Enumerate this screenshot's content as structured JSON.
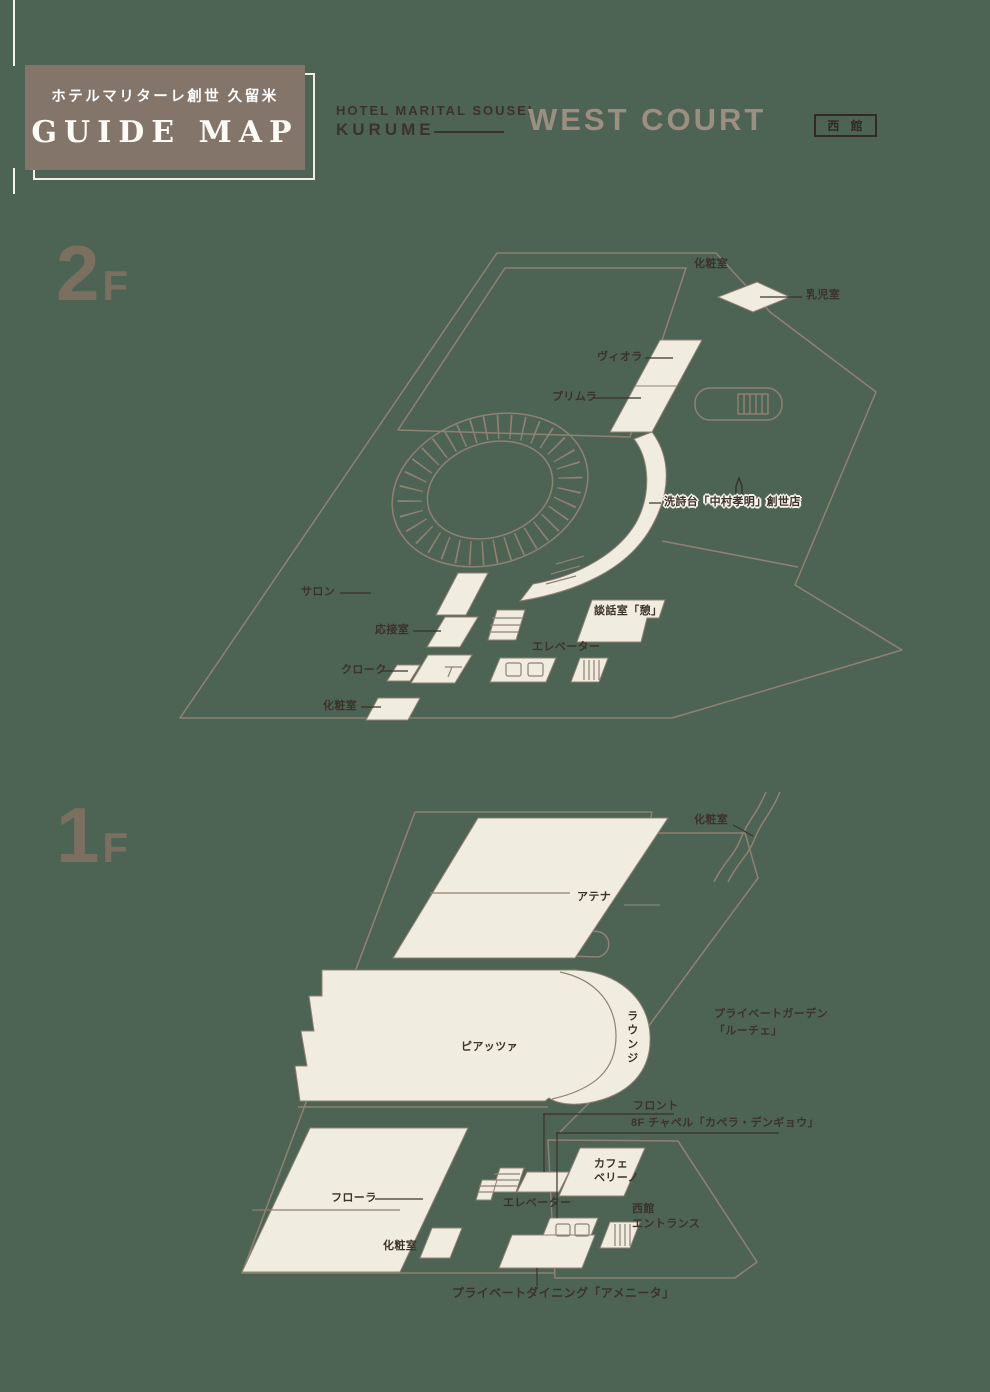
{
  "colors": {
    "background": "#4D6455",
    "room_cream": "#F1ECE0",
    "wall_line": "#8F8173",
    "ink": "#3B322A",
    "logo_box": "#84756A",
    "floor_numeral": "#7B7060",
    "court_title": "#9C8E81"
  },
  "header": {
    "logo_jp": "ホテルマリターレ創世 久留米",
    "logo_en": "GUIDE MAP",
    "hotel_en_line1": "HOTEL MARITAL SOUSEI",
    "hotel_en_line2": "KURUME",
    "building_en": "WEST COURT",
    "building_badge": "西 館"
  },
  "icons": {
    "restaurant_marker": "spire-icon"
  },
  "floor2": {
    "number": "2",
    "suffix": "F",
    "labels": {
      "restroom_top": "化粧室",
      "nursing_room": "乳児室",
      "viola": "ヴィオラ",
      "primula": "プリムラ",
      "restaurant": "洗詩台「中村孝明」創世店",
      "salon": "サロン",
      "reception": "応接室",
      "parlor": "談話室「憩」",
      "elevator": "エレベーター",
      "cloak": "クローク",
      "restroom_bottom": "化粧室"
    }
  },
  "floor1": {
    "number": "1",
    "suffix": "F",
    "labels": {
      "restroom_top": "化粧室",
      "athena": "アテナ",
      "piazza": "ピアッツァ",
      "lounge": "ラウンジ",
      "garden_line1": "プライベートガーデン",
      "garden_line2": "「ルーチェ」",
      "front": "フロント",
      "chapel": "8F チャペル「カペラ・デンギョウ」",
      "cafe_line1": "カフェ",
      "cafe_line2": "ベリーノ",
      "elevator": "エレベーター",
      "entrance_line1": "西館",
      "entrance_line2": "エントランス",
      "flora": "フローラ",
      "restroom_bottom": "化粧室",
      "dining": "プライベートダイニング「アメニータ」"
    }
  }
}
